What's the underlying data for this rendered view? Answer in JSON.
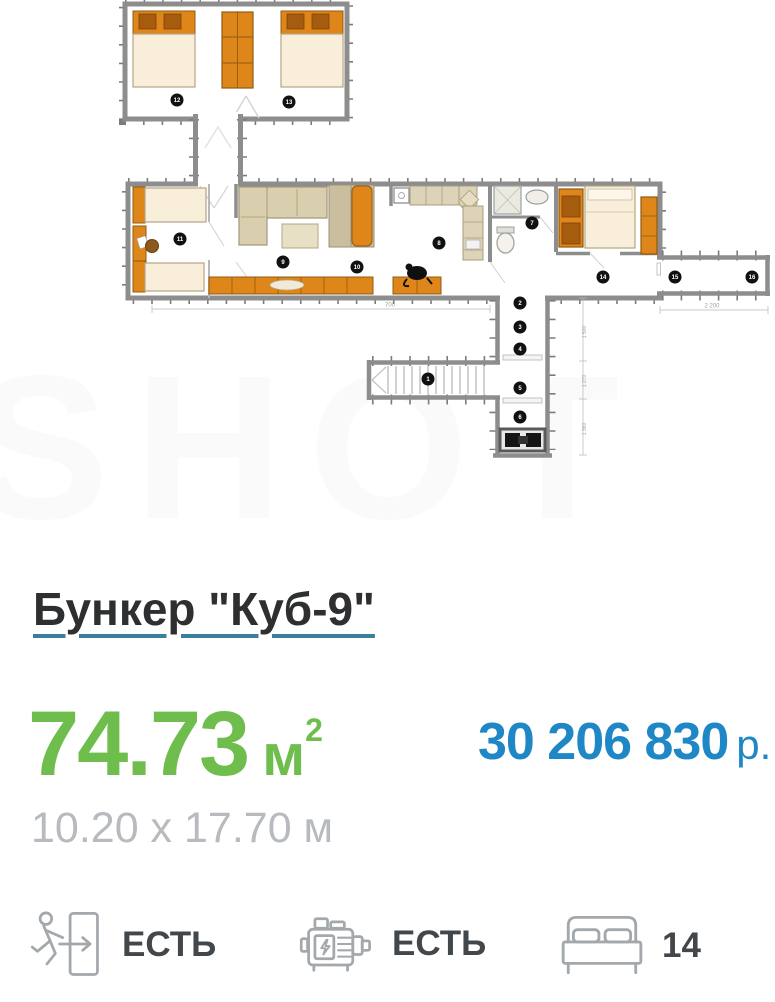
{
  "watermark": "SHOT",
  "listing": {
    "title": "Бункер \"Куб-9\"",
    "area_value": "74.73",
    "area_unit": "м",
    "area_sup": "2",
    "price_value": "30 206 830",
    "price_currency": "р.",
    "dimensions": "10.20 x 17.70 м"
  },
  "plan": {
    "markers": [
      "12",
      "13",
      "11",
      "9",
      "10",
      "8",
      "7",
      "14",
      "15",
      "16",
      "1",
      "2",
      "3",
      "4",
      "5",
      "6"
    ],
    "dimension_labels": {
      "bottom": "700",
      "right": "2 200",
      "vertical_1": "1 500",
      "vertical_2": "1 270",
      "vertical_3": "1 360"
    }
  },
  "features": [
    {
      "icon": "emergency-exit-icon",
      "label": "ЕСТЬ"
    },
    {
      "icon": "generator-icon",
      "label": "ЕСТЬ"
    },
    {
      "icon": "sleeping-places-icon",
      "label": "14"
    }
  ],
  "colors": {
    "area_green": "#6fbe4d",
    "price_blue": "#1f87c5",
    "title_underline_teal": "#39809f",
    "plan_orange": "#df861b",
    "plan_wall_gray": "#8d8d8d"
  }
}
